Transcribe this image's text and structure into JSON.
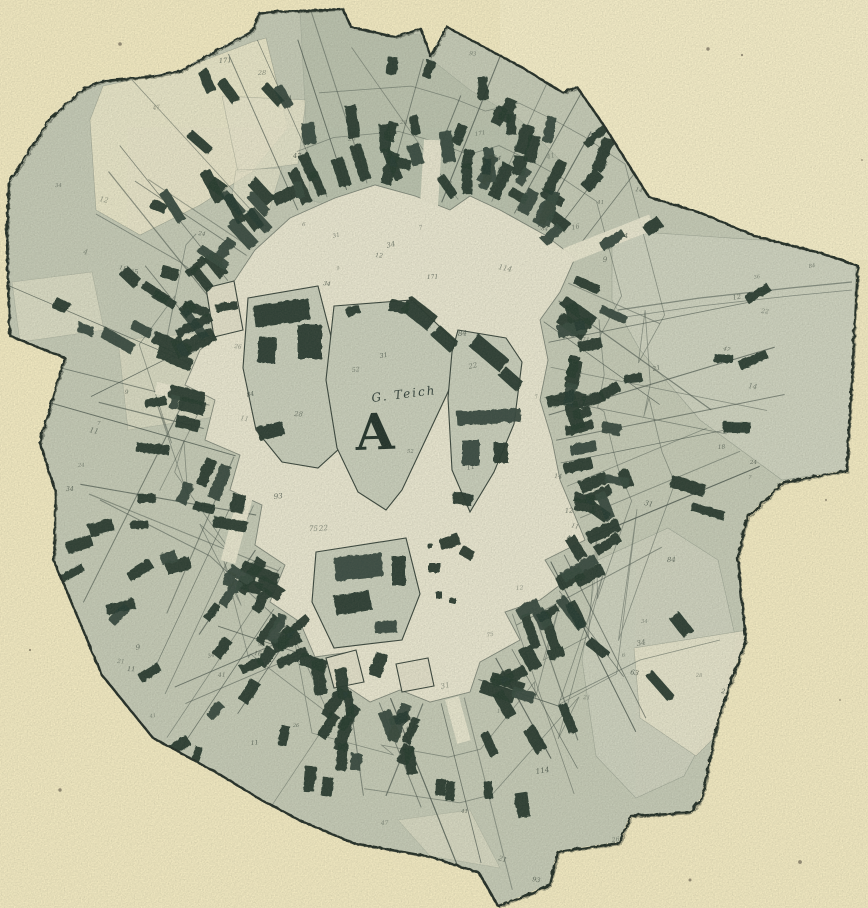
{
  "figure": {
    "kind": "historical village cadastral plan (round village with central green)",
    "central_area_label": "A",
    "pond_label": "G. Teich"
  },
  "palette": {
    "paper": "#f3eac2",
    "paperBright": "#f7efcb",
    "field": "#c5cab6",
    "fieldDark": "#b2bca8",
    "nwField": "#e9e5c9",
    "neField": "#cfd3c0",
    "lightPatch": "#e7e4cb",
    "plaza": "#e9e6d0",
    "island": "#c9cebb",
    "blob": "#e2dfc9",
    "building": "#263a30",
    "buildingLight": "#37493d",
    "line": "#46524a",
    "outline": "#232d26",
    "number": "#39453c",
    "speck": "#4a4438"
  },
  "geometry": {
    "seed": 11,
    "center": [
      428,
      438
    ],
    "outline": [
      [
        50,
        117
      ],
      [
        85,
        87
      ],
      [
        102,
        80
      ],
      [
        148,
        76
      ],
      [
        180,
        70
      ],
      [
        252,
        30
      ],
      [
        258,
        12
      ],
      [
        342,
        8
      ],
      [
        350,
        26
      ],
      [
        394,
        36
      ],
      [
        420,
        28
      ],
      [
        430,
        56
      ],
      [
        446,
        26
      ],
      [
        468,
        38
      ],
      [
        520,
        66
      ],
      [
        562,
        92
      ],
      [
        576,
        86
      ],
      [
        604,
        126
      ],
      [
        648,
        196
      ],
      [
        700,
        212
      ],
      [
        756,
        236
      ],
      [
        820,
        252
      ],
      [
        857,
        265
      ],
      [
        852,
        360
      ],
      [
        846,
        470
      ],
      [
        782,
        482
      ],
      [
        746,
        518
      ],
      [
        737,
        558
      ],
      [
        745,
        640
      ],
      [
        718,
        716
      ],
      [
        701,
        798
      ],
      [
        690,
        812
      ],
      [
        630,
        815
      ],
      [
        619,
        842
      ],
      [
        557,
        851
      ],
      [
        549,
        884
      ],
      [
        520,
        897
      ],
      [
        497,
        905
      ],
      [
        478,
        872
      ],
      [
        430,
        856
      ],
      [
        352,
        842
      ],
      [
        300,
        820
      ],
      [
        262,
        800
      ],
      [
        216,
        772
      ],
      [
        152,
        737
      ],
      [
        101,
        674
      ],
      [
        53,
        560
      ],
      [
        55,
        492
      ],
      [
        39,
        442
      ],
      [
        64,
        357
      ],
      [
        9,
        335
      ],
      [
        6,
        240
      ],
      [
        8,
        182
      ]
    ],
    "plaza": [
      [
        290,
        218
      ],
      [
        335,
        198
      ],
      [
        375,
        185
      ],
      [
        415,
        196
      ],
      [
        450,
        210
      ],
      [
        470,
        196
      ],
      [
        500,
        210
      ],
      [
        545,
        235
      ],
      [
        575,
        258
      ],
      [
        560,
        292
      ],
      [
        540,
        320
      ],
      [
        548,
        360
      ],
      [
        540,
        400
      ],
      [
        552,
        440
      ],
      [
        560,
        480
      ],
      [
        585,
        540
      ],
      [
        545,
        560
      ],
      [
        560,
        585
      ],
      [
        540,
        600
      ],
      [
        505,
        612
      ],
      [
        520,
        640
      ],
      [
        480,
        662
      ],
      [
        470,
        692
      ],
      [
        430,
        702
      ],
      [
        400,
        690
      ],
      [
        370,
        702
      ],
      [
        340,
        682
      ],
      [
        350,
        652
      ],
      [
        315,
        657
      ],
      [
        300,
        622
      ],
      [
        270,
        602
      ],
      [
        285,
        565
      ],
      [
        255,
        545
      ],
      [
        262,
        505
      ],
      [
        230,
        490
      ],
      [
        240,
        455
      ],
      [
        205,
        440
      ],
      [
        215,
        400
      ],
      [
        185,
        385
      ],
      [
        200,
        350
      ],
      [
        225,
        330
      ],
      [
        210,
        300
      ],
      [
        235,
        280
      ],
      [
        255,
        250
      ]
    ],
    "lightPatches": [
      {
        "pts": [
          [
            90,
            120
          ],
          [
            103,
            86
          ],
          [
            150,
            76
          ],
          [
            200,
            62
          ],
          [
            252,
            42
          ],
          [
            266,
            38
          ],
          [
            288,
            128
          ],
          [
            252,
            172
          ],
          [
            200,
            205
          ],
          [
            140,
            235
          ],
          [
            96,
            210
          ]
        ],
        "fill": "nwField",
        "op": 0.95
      },
      {
        "pts": [
          [
            222,
            96
          ],
          [
            306,
            100
          ],
          [
            298,
            164
          ],
          [
            238,
            172
          ]
        ],
        "fill": "lightPatch",
        "op": 0.85
      },
      {
        "pts": [
          [
            236,
            170
          ],
          [
            282,
            168
          ],
          [
            268,
            214
          ],
          [
            230,
            208
          ]
        ],
        "fill": "lightPatch",
        "op": 0.7
      },
      {
        "pts": [
          [
            12,
            282
          ],
          [
            92,
            272
          ],
          [
            104,
            330
          ],
          [
            20,
            342
          ]
        ],
        "fill": "lightPatch",
        "op": 0.6
      },
      {
        "pts": [
          [
            118,
            340
          ],
          [
            208,
            332
          ],
          [
            220,
            416
          ],
          [
            128,
            430
          ]
        ],
        "fill": "lightPatch",
        "op": 0.55
      },
      {
        "pts": [
          [
            612,
            230
          ],
          [
            700,
            236
          ],
          [
            790,
            242
          ],
          [
            856,
            262
          ],
          [
            850,
            470
          ],
          [
            782,
            480
          ],
          [
            700,
            420
          ],
          [
            640,
            350
          ],
          [
            612,
            300
          ]
        ],
        "fill": "neField",
        "op": 0.9
      },
      {
        "pts": [
          [
            598,
            560
          ],
          [
            668,
            528
          ],
          [
            718,
            560
          ],
          [
            736,
            640
          ],
          [
            716,
            716
          ],
          [
            684,
            776
          ],
          [
            636,
            798
          ],
          [
            596,
            756
          ],
          [
            582,
            660
          ]
        ],
        "fill": "neField",
        "op": 0.85
      },
      {
        "pts": [
          [
            634,
            648
          ],
          [
            748,
            630
          ],
          [
            752,
            700
          ],
          [
            696,
            756
          ],
          [
            640,
            718
          ]
        ],
        "fill": "lightPatch",
        "op": 0.9
      },
      {
        "pts": [
          [
            398,
            820
          ],
          [
            470,
            810
          ],
          [
            500,
            868
          ],
          [
            430,
            856
          ]
        ],
        "fill": "lightPatch",
        "op": 0.5
      },
      {
        "pts": [
          [
            300,
            10
          ],
          [
            345,
            10
          ],
          [
            352,
            30
          ],
          [
            420,
            35
          ],
          [
            432,
            60
          ],
          [
            470,
            90
          ],
          [
            520,
            120
          ],
          [
            560,
            160
          ],
          [
            540,
            230
          ],
          [
            470,
            230
          ],
          [
            380,
            220
          ],
          [
            310,
            200
          ]
        ],
        "fill": "fieldDark",
        "op": 0.55
      }
    ],
    "roads": [
      {
        "pts": [
          [
            618,
            310
          ],
          [
            700,
            298
          ],
          [
            790,
            288
          ],
          [
            852,
            282
          ]
        ],
        "w": 1.2
      },
      {
        "pts": [
          [
            618,
            318
          ],
          [
            700,
            306
          ],
          [
            790,
            296
          ],
          [
            852,
            290
          ]
        ],
        "w": 0.8
      },
      {
        "pts": [
          [
            100,
            500
          ],
          [
            210,
            556
          ],
          [
            300,
            640
          ]
        ],
        "w": 1.0
      },
      {
        "pts": [
          [
            560,
            700
          ],
          [
            640,
            660
          ],
          [
            720,
            640
          ]
        ],
        "w": 0.9
      },
      {
        "pts": [
          [
            96,
            214
          ],
          [
            180,
            262
          ],
          [
            230,
            300
          ]
        ],
        "w": 0.9
      }
    ],
    "streets": [
      {
        "x1": 428,
        "y1": 222,
        "x2": 433,
        "y2": 140,
        "w": 18
      },
      {
        "x1": 566,
        "y1": 256,
        "x2": 652,
        "y2": 222,
        "w": 16
      },
      {
        "x1": 452,
        "y1": 698,
        "x2": 464,
        "y2": 742,
        "w": 14
      },
      {
        "x1": 253,
        "y1": 468,
        "x2": 228,
        "y2": 562,
        "w": 15
      },
      {
        "x1": 196,
        "y1": 396,
        "x2": 156,
        "y2": 388,
        "w": 12
      }
    ],
    "islands": [
      {
        "name": "island-left",
        "pts": [
          [
            248,
            298
          ],
          [
            318,
            286
          ],
          [
            336,
            356
          ],
          [
            330,
            362
          ],
          [
            340,
            448
          ],
          [
            318,
            468
          ],
          [
            282,
            462
          ],
          [
            256,
            430
          ],
          [
            243,
            368
          ]
        ],
        "fill": "island"
      },
      {
        "name": "island-central-green",
        "pts": [
          [
            334,
            306
          ],
          [
            412,
            300
          ],
          [
            462,
            348
          ],
          [
            448,
            392
          ],
          [
            402,
            490
          ],
          [
            386,
            510
          ],
          [
            358,
            492
          ],
          [
            337,
            448
          ],
          [
            326,
            380
          ]
        ],
        "fill": "island"
      },
      {
        "name": "island-right",
        "pts": [
          [
            458,
            330
          ],
          [
            506,
            338
          ],
          [
            522,
            362
          ],
          [
            514,
            424
          ],
          [
            494,
            472
          ],
          [
            470,
            512
          ],
          [
            452,
            470
          ],
          [
            448,
            398
          ],
          [
            452,
            352
          ]
        ],
        "fill": "island"
      },
      {
        "name": "island-south",
        "pts": [
          [
            316,
            552
          ],
          [
            406,
            538
          ],
          [
            420,
            594
          ],
          [
            402,
            640
          ],
          [
            334,
            648
          ],
          [
            312,
            602
          ]
        ],
        "fill": "island"
      },
      {
        "name": "blob-sw",
        "pts": [
          [
            326,
            658
          ],
          [
            356,
            650
          ],
          [
            364,
            682
          ],
          [
            334,
            688
          ]
        ],
        "fill": "blob"
      },
      {
        "name": "blob-se",
        "pts": [
          [
            396,
            664
          ],
          [
            428,
            658
          ],
          [
            434,
            686
          ],
          [
            402,
            692
          ]
        ],
        "fill": "blob"
      },
      {
        "name": "plot-west",
        "pts": [
          [
            206,
            288
          ],
          [
            234,
            281
          ],
          [
            243,
            330
          ],
          [
            214,
            337
          ]
        ],
        "fill": "blob"
      }
    ],
    "islandBuildings": [
      [
        281,
        312,
        56,
        22,
        -8
      ],
      [
        309,
        341,
        24,
        34,
        0
      ],
      [
        266,
        349,
        18,
        26,
        5
      ],
      [
        270,
        430,
        26,
        14,
        -15
      ],
      [
        398,
        306,
        20,
        12,
        10
      ],
      [
        418,
        312,
        34,
        18,
        38
      ],
      [
        444,
        338,
        26,
        14,
        42
      ],
      [
        352,
        310,
        14,
        9,
        -20
      ],
      [
        488,
        352,
        40,
        16,
        40
      ],
      [
        510,
        378,
        24,
        12,
        42
      ],
      [
        488,
        416,
        64,
        14,
        -3
      ],
      [
        470,
        452,
        18,
        26,
        0
      ],
      [
        500,
        452,
        14,
        20,
        0
      ],
      [
        462,
        498,
        20,
        12,
        10
      ],
      [
        358,
        566,
        48,
        24,
        -6
      ],
      [
        352,
        602,
        36,
        20,
        -10
      ],
      [
        398,
        570,
        14,
        30,
        0
      ],
      [
        385,
        626,
        22,
        12,
        -4
      ],
      [
        449,
        541,
        20,
        12,
        -20
      ],
      [
        466,
        552,
        14,
        10,
        30
      ],
      [
        434,
        567,
        12,
        10,
        0
      ],
      [
        438,
        594,
        7,
        7,
        0
      ],
      [
        452,
        600,
        6,
        6,
        0
      ],
      [
        429,
        545,
        5,
        5,
        0
      ],
      [
        226,
        306,
        22,
        8,
        -10
      ]
    ],
    "rings": {
      "inner": {
        "count": 96,
        "offMin": 6,
        "offMax": 20,
        "lenMin": 24,
        "lenMax": 40,
        "wMin": 9,
        "wMax": 14
      },
      "outer": {
        "count": 54,
        "offMin": 34,
        "offMax": 62,
        "lenMin": 16,
        "lenMax": 30,
        "wMin": 8,
        "wMax": 12,
        "skip": 0.28
      }
    },
    "clusters": [
      {
        "x0": 150,
        "y0": 60,
        "x1": 540,
        "y1": 225,
        "count": 40
      },
      {
        "x0": 60,
        "y0": 240,
        "x1": 200,
        "y1": 340,
        "count": 9
      },
      {
        "x0": 520,
        "y0": 120,
        "x1": 660,
        "y1": 260,
        "count": 12
      },
      {
        "x0": 580,
        "y0": 280,
        "x1": 760,
        "y1": 520,
        "count": 14
      },
      {
        "x0": 560,
        "y0": 560,
        "x1": 700,
        "y1": 790,
        "count": 4
      },
      {
        "x0": 300,
        "y0": 700,
        "x1": 560,
        "y1": 820,
        "count": 12
      },
      {
        "x0": 120,
        "y0": 560,
        "x1": 300,
        "y1": 760,
        "count": 12
      },
      {
        "x0": 60,
        "y0": 380,
        "x1": 170,
        "y1": 620,
        "count": 10
      }
    ],
    "radialLines": {
      "count": 66,
      "minLen": 90,
      "maxLen": 250
    },
    "arcs": [
      {
        "off": 58,
        "t0": 0.02,
        "t1": 0.97
      },
      {
        "off": 105,
        "t0": 0.04,
        "t1": 0.58
      }
    ],
    "numbers": {
      "count": 150,
      "glyphs": [
        "4",
        "6",
        "7",
        "9",
        "11",
        "12",
        "14",
        "16",
        "18",
        "21",
        "22",
        "24",
        "26",
        "28",
        "31",
        "34",
        "36",
        "41",
        "47",
        "52",
        "63",
        "75",
        "84",
        "93",
        "114",
        "171"
      ]
    },
    "specks": [
      [
        708,
        49
      ],
      [
        742,
        55
      ],
      [
        120,
        44
      ],
      [
        826,
        500
      ],
      [
        840,
        700
      ],
      [
        60,
        790
      ],
      [
        800,
        862
      ],
      [
        30,
        650
      ],
      [
        862,
        160
      ],
      [
        690,
        880
      ]
    ],
    "labelPos": {
      "A": [
        356,
        450
      ],
      "teich": [
        372,
        402
      ]
    }
  }
}
